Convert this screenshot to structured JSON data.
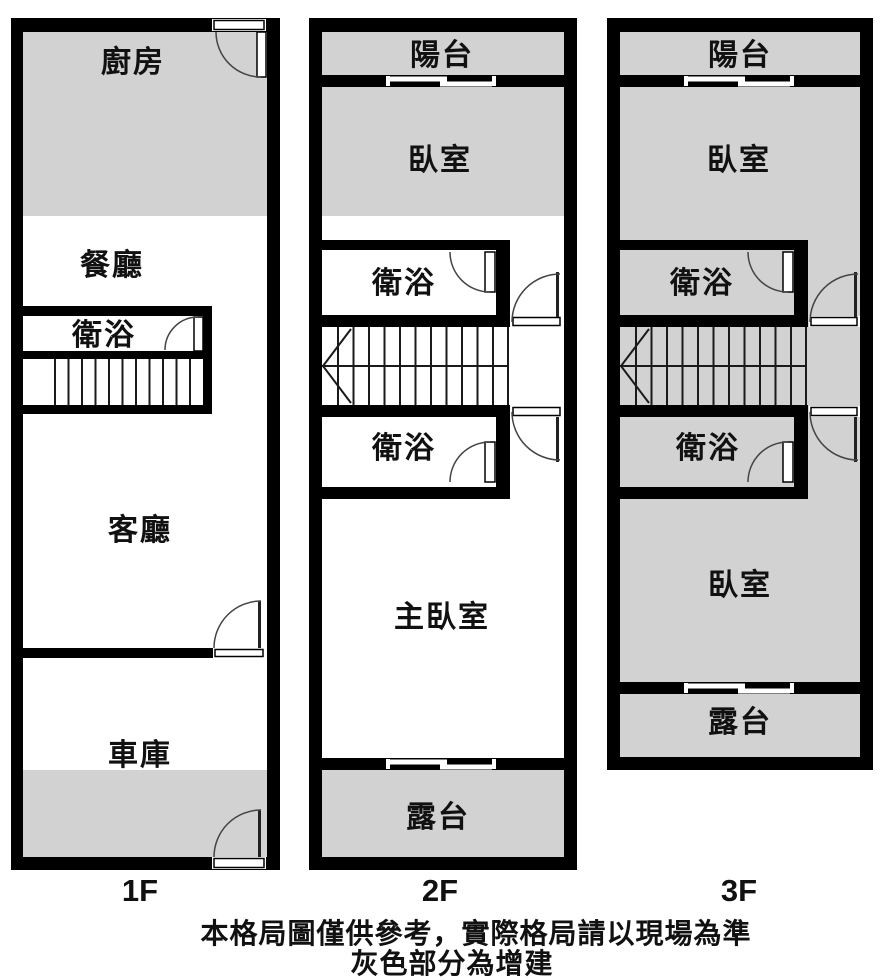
{
  "colors": {
    "wall": "#000000",
    "addition_gray": "#d2d2d2",
    "background": "#ffffff",
    "thin_line": "#1a1a1a"
  },
  "floors": [
    {
      "label": "1F",
      "rooms": [
        {
          "key": "kitchen",
          "label": "廚房"
        },
        {
          "key": "dining-room",
          "label": "餐廳"
        },
        {
          "key": "bathroom",
          "label": "衛浴"
        },
        {
          "key": "living-room",
          "label": "客廳"
        },
        {
          "key": "garage",
          "label": "車庫"
        }
      ]
    },
    {
      "label": "2F",
      "rooms": [
        {
          "key": "balcony",
          "label": "陽台"
        },
        {
          "key": "bedroom",
          "label": "臥室"
        },
        {
          "key": "bathroom-upper",
          "label": "衛浴"
        },
        {
          "key": "bathroom-lower",
          "label": "衛浴"
        },
        {
          "key": "master-bedroom",
          "label": "主臥室"
        },
        {
          "key": "terrace",
          "label": "露台"
        }
      ]
    },
    {
      "label": "3F",
      "rooms": [
        {
          "key": "balcony",
          "label": "陽台"
        },
        {
          "key": "bedroom-front",
          "label": "臥室"
        },
        {
          "key": "bathroom-upper",
          "label": "衛浴"
        },
        {
          "key": "bathroom-lower",
          "label": "衛浴"
        },
        {
          "key": "bedroom-rear",
          "label": "臥室"
        },
        {
          "key": "terrace",
          "label": "露台"
        }
      ]
    }
  ],
  "captions": {
    "line1": "本格局圖僅供參考，實際格局請以現場為準",
    "line2": "灰色部分為增建"
  }
}
